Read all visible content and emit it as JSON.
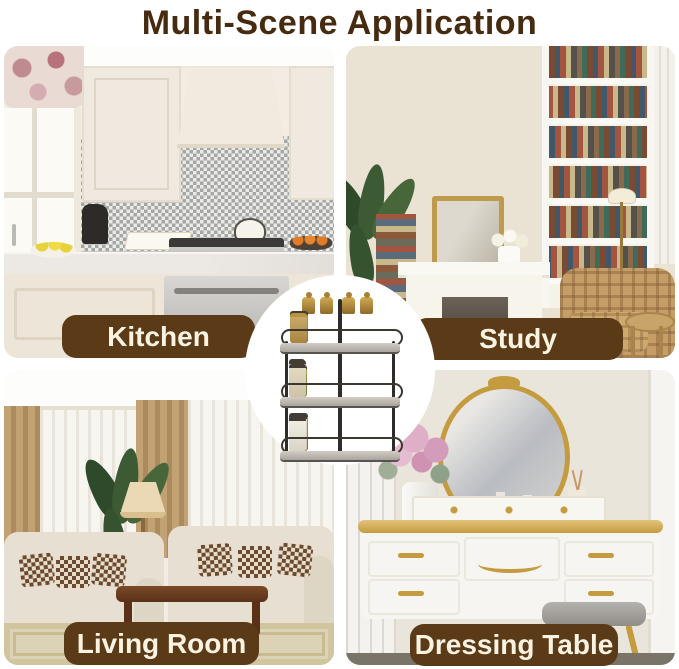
{
  "title": "Multi-Scene Application",
  "scenes": [
    {
      "id": "kitchen",
      "label": "Kitchen"
    },
    {
      "id": "study",
      "label": "Study"
    },
    {
      "id": "living-room",
      "label": "Living Room"
    },
    {
      "id": "dressing-table",
      "label": "Dressing Table"
    }
  ],
  "product": {
    "image_name": "three-tier-rotating-spice-rack"
  },
  "colors": {
    "title_text": "#472b10",
    "label_background": "#5a3a17",
    "label_text": "#faf3e2",
    "page_background": "#ffffff"
  }
}
